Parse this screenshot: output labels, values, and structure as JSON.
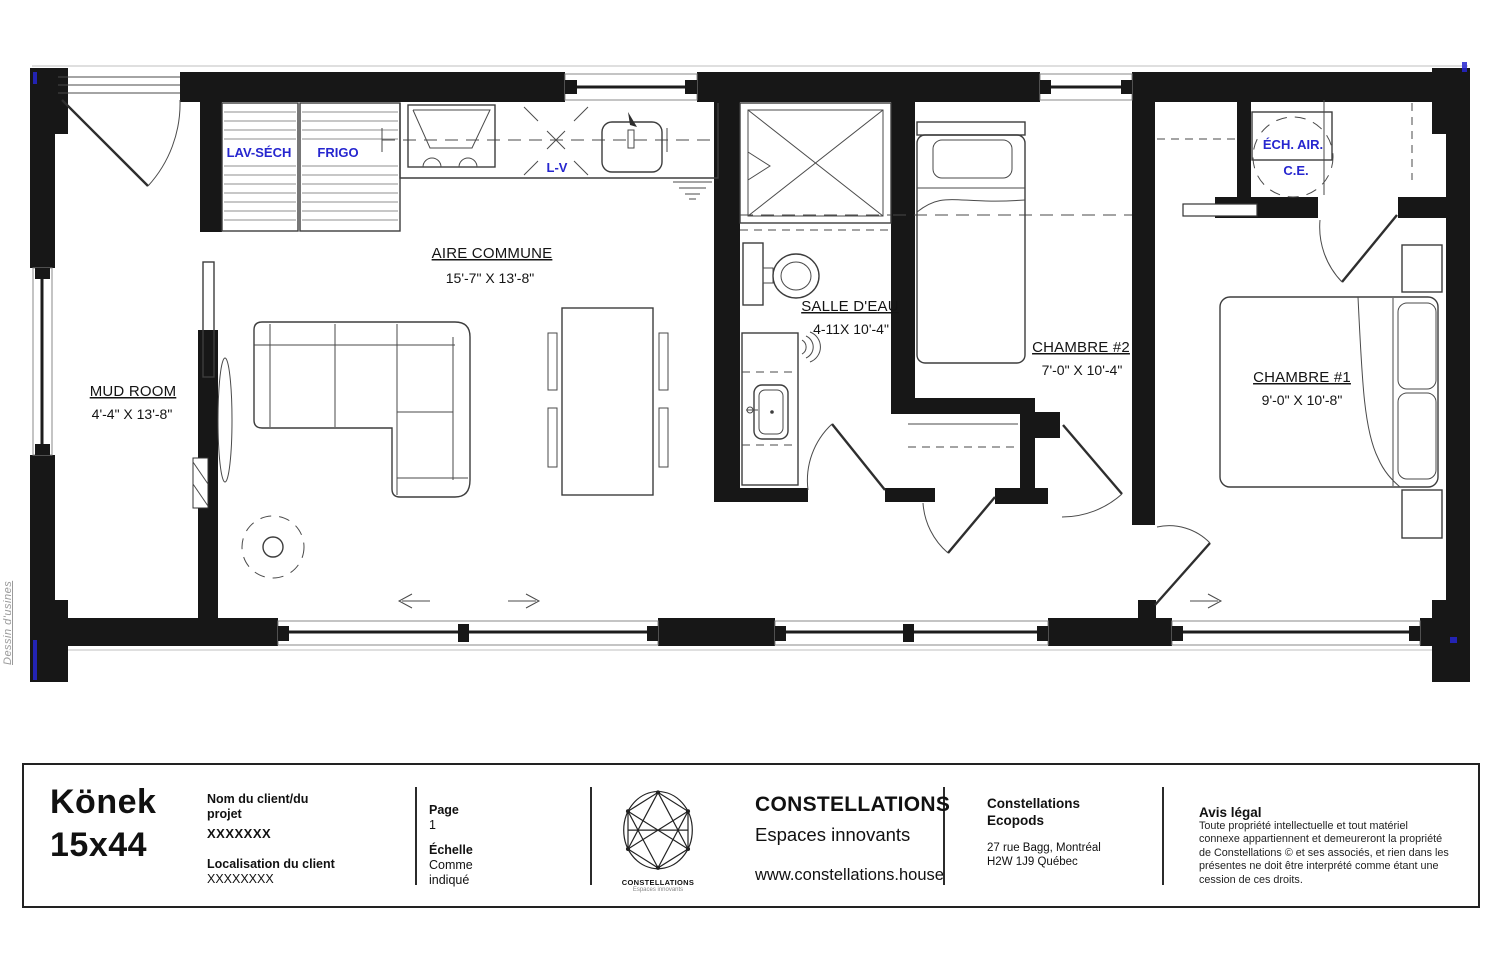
{
  "watermark": "Dessin d'usines",
  "colors": {
    "wall": "#171717",
    "drawing_line": "#3d3d3d",
    "annotation_blue": "#2626cf",
    "watermark_gray": "#9a9a9a"
  },
  "plan": {
    "rooms": [
      {
        "id": "mud-room",
        "name": "MUD ROOM",
        "dims": "4'-4\" X 13'-8\""
      },
      {
        "id": "aire-commune",
        "name": "AIRE COMMUNE",
        "dims": "15'-7\" X 13'-8\""
      },
      {
        "id": "salle-deau",
        "name": "SALLE D'EAU",
        "dims": "4-11X 10'-4\""
      },
      {
        "id": "chambre-2",
        "name": "CHAMBRE #2",
        "dims": "7'-0\" X 10'-4\""
      },
      {
        "id": "chambre-1",
        "name": "CHAMBRE #1",
        "dims": "9'-0\" X 10'-8\""
      }
    ],
    "equipment": [
      {
        "id": "lav-sech",
        "label": "LAV-SÉCH"
      },
      {
        "id": "frigo",
        "label": "FRIGO"
      },
      {
        "id": "lv",
        "label": "L-V"
      },
      {
        "id": "ech-air",
        "label": "ÉCH. AIR."
      },
      {
        "id": "ce",
        "label": "C.E."
      }
    ]
  },
  "title_block": {
    "model": {
      "line1": "Könek",
      "line2": "15x44"
    },
    "client": {
      "name_label": "Nom du client/du projet",
      "name_value": "XXXXXXX",
      "location_label": "Localisation du client",
      "location_value": "XXXXXXXX"
    },
    "page": {
      "label": "Page",
      "value": "1"
    },
    "scale": {
      "label": "Échelle",
      "value_line1": "Comme",
      "value_line2": "indiqué"
    },
    "logo": {
      "caption": "CONSTELLATIONS",
      "tagline": "Espaces innovants"
    },
    "company": {
      "name": "CONSTELLATIONS",
      "tagline": "Espaces innovants",
      "website": "www.constellations.house"
    },
    "office": {
      "name_line1": "Constellations",
      "name_line2": "Ecopods",
      "address_line1": "27 rue Bagg, Montréal",
      "address_line2": "H2W 1J9 Québec"
    },
    "legal": {
      "title": "Avis légal",
      "lines": [
        "Toute propriété intellectuelle et tout matériel",
        "connexe appartiennent et demeureront la propriété",
        "de Constellations © et ses associés, et rien dans les",
        "présentes ne doit être interprété comme étant une",
        "cession de ces droits."
      ]
    }
  }
}
